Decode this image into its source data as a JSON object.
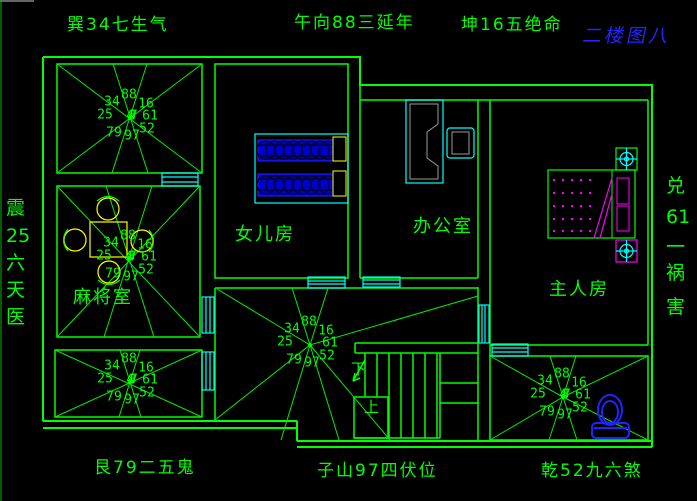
{
  "canvas": {
    "width": 697,
    "height": 501
  },
  "colors": {
    "background": "#000000",
    "line_green": "#00ff00",
    "window_cyan": "#00ffff",
    "furniture_blue": "#2222ff",
    "bed_fill_blue": "#0000cc",
    "yellow": "#ffff00",
    "magenta": "#ff00ff",
    "gray": "#9a9a9a",
    "title_blue": "#2424ff"
  },
  "floor_title": "二楼图八",
  "compass_labels": {
    "top_left": "巽34七生气",
    "top_center": "午向88三延年",
    "top_right": "坤16五绝命",
    "bottom_left": "艮79二五鬼",
    "bottom_center": "子山97四伏位",
    "bottom_right": "乾52九六煞",
    "left_chars": [
      "震",
      "25",
      "六",
      "天",
      "医"
    ],
    "right_chars": [
      "兑",
      "61",
      "一",
      "祸",
      "害"
    ]
  },
  "rooms": {
    "daughter": "女儿房",
    "office": "办公室",
    "master": "主人房",
    "mahjong": "麻将室"
  },
  "stairs": {
    "down": "下",
    "up": "上"
  },
  "star": {
    "top_left": "34",
    "top": "88",
    "top_right": "16",
    "left": "25",
    "right": "61",
    "bottom_left": "79",
    "bottom": "97",
    "bottom_right": "52",
    "center": "487"
  }
}
